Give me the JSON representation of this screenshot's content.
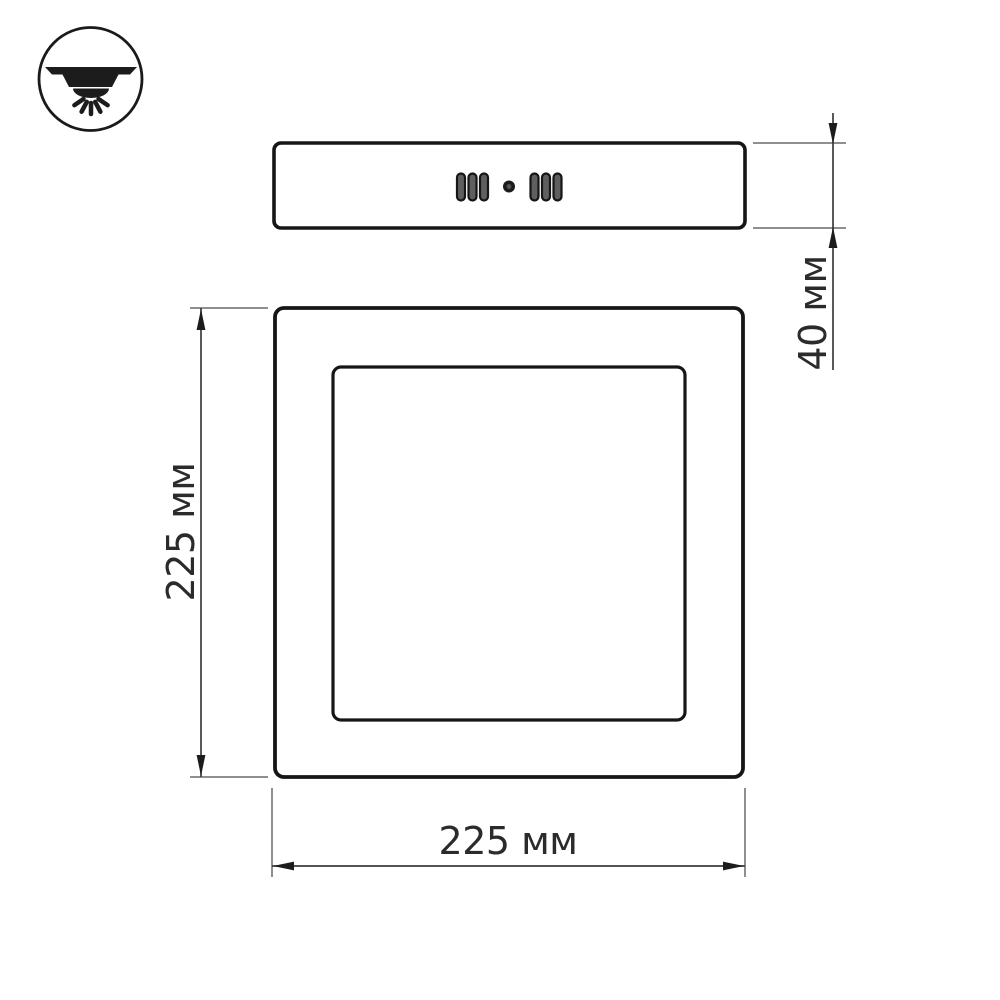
{
  "drawing": {
    "title": "LED panel fixture dimension drawing",
    "icon": {
      "name": "surface-mount-ceiling-light-icon",
      "meaning": "surface (накладной) ceiling mounting with downward light"
    },
    "views": {
      "side": {
        "name": "side-view",
        "vent_slots_left": 3,
        "vent_slots_right": 3,
        "center_dot": 1
      },
      "front": {
        "name": "front-view",
        "inner_panel": "diffuser square"
      }
    },
    "dimensions": {
      "depth": {
        "label": "40 мм"
      },
      "height": {
        "label": "225 мм"
      },
      "width": {
        "label": "225 мм"
      }
    },
    "colors": {
      "outline": "#161616",
      "dimension_line": "#3c3c3c",
      "extension_line": "#8f8f8f",
      "text": "#2b2b2b",
      "background": "#ffffff"
    }
  }
}
